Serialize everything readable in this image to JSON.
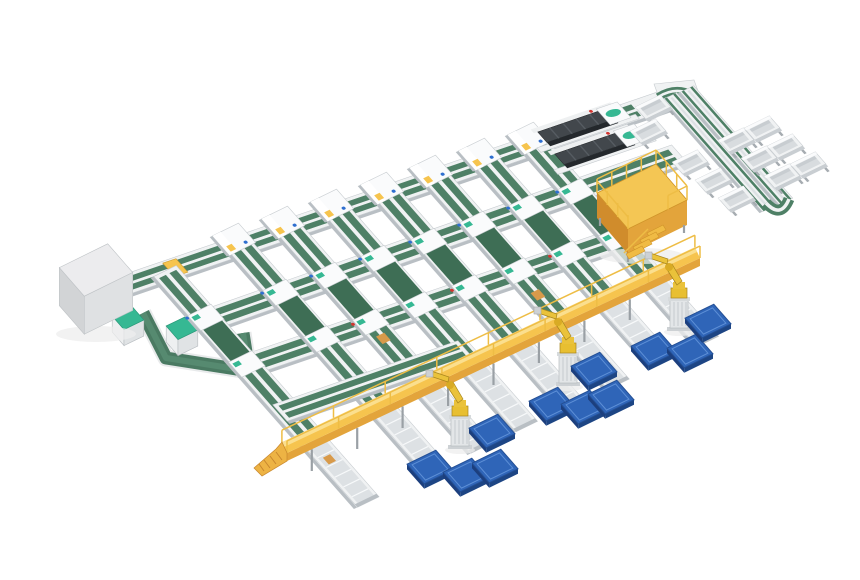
{
  "scene": {
    "label": "Automated production line with conveyors, palletizing robots and overhead walkway — isometric 3D render",
    "background": "#ffffff",
    "view": "isometric"
  },
  "colors": {
    "belt-green": "#4e8066",
    "belt-green-deep": "#3e6e55",
    "belt-green-dark": "#2f5743",
    "frame-white": "#f0f2f3",
    "frame-bright": "#fafbfc",
    "frame-shade": "#b9bfc4",
    "frame-edge": "#c6cbcf",
    "roller-gray": "#dde1e4",
    "roller-stripe": "#f7f9fa",
    "leg-gray": "#9aa0a5",
    "walk-yellow": "#f6c44e",
    "walk-yellow-face": "#e3a43b",
    "walk-yellow-deep": "#d08c2c",
    "rail-yellow": "#eebd45",
    "robot-yellow": "#e8bf31",
    "robot-yellow-dark": "#a8861d",
    "pallet-blue": "#2f65b8",
    "pallet-blue-side": "#1d4584",
    "pallet-blue-line": "#5d8fd6",
    "machine-charcoal": "#42474c",
    "machine-charcoal-dark": "#24282c",
    "teal": "#36b893",
    "red": "#d23530",
    "signal-blue": "#2f6fd0",
    "cabinet-top": "#ececee",
    "cabinet-left": "#d2d4d6",
    "cabinet-right": "#dfe1e3",
    "item-orange": "#d89a4a"
  },
  "inventory": {
    "process_lines": 8,
    "line_headers": 7,
    "cross_conveyors": 4,
    "dark_machines": 2,
    "overhead_walkway": 1,
    "walkway_ramp": 1,
    "robot_arms": 3,
    "blue_pallets": 11,
    "tote_bins": 11,
    "return_rails": 2,
    "access_platform": 1,
    "electrical_cabinet": 1,
    "belt_loop_cabinets": 2,
    "tail_conveyors": 8
  }
}
